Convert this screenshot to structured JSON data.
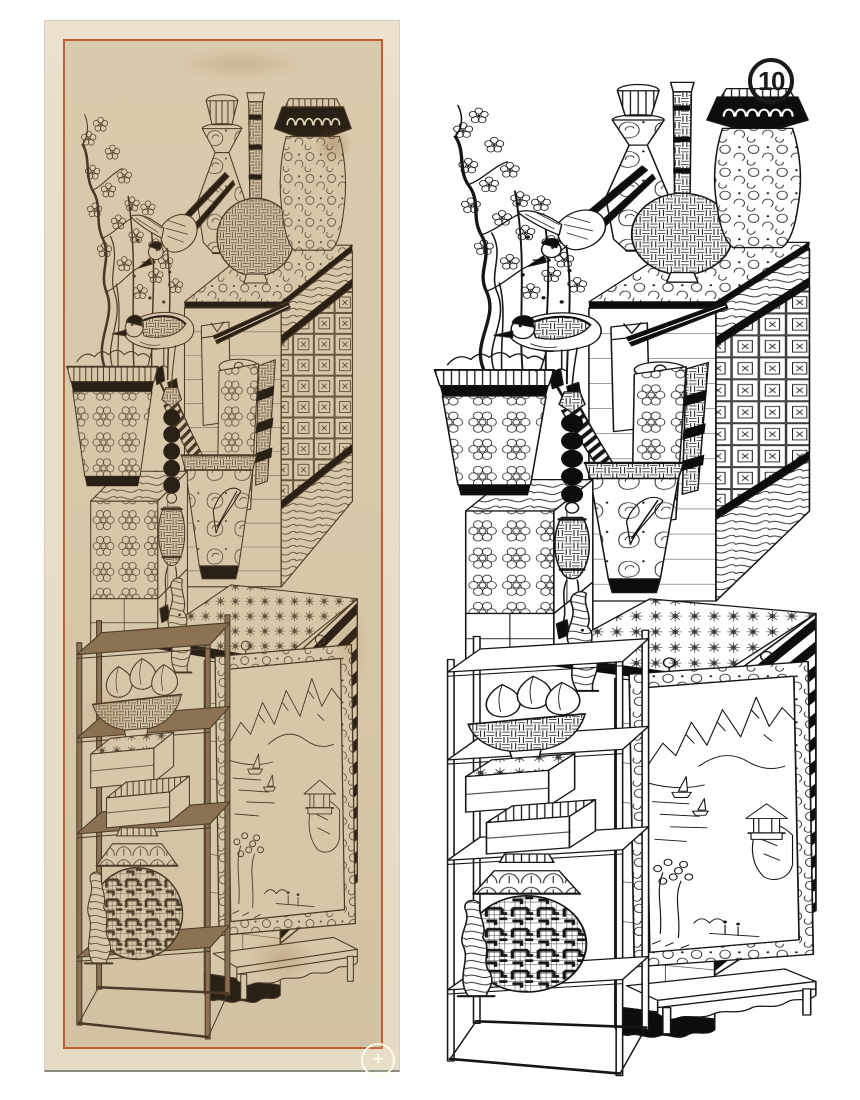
{
  "page": {
    "background_color": "#ffffff"
  },
  "figure_badge": {
    "number": "10",
    "color": "#1a1a1a"
  },
  "left_panel": {
    "label": "painting-photograph",
    "mat_color": "#e9dec8",
    "paper_color": "#d7c7a9",
    "border_color": "#c05f33",
    "ink_color": "#4a3a27",
    "accent_dark": "#2a2116",
    "wood_color": "#8a7253",
    "highlight_color": "#e0d2b6",
    "zoom_button_label": "+"
  },
  "right_panel": {
    "label": "line-drawing",
    "background_color": "#ffffff",
    "ink_color": "#161616",
    "accent_dark": "#0d0d0d"
  },
  "artwork": {
    "type": "chaekgeori-still-life-panel",
    "depicted_elements": [
      "plum-blossom-branch",
      "diving-bird",
      "perched-bird",
      "flowerpot-planter",
      "faceted-bottle-vase",
      "long-necked-vase",
      "lidded-floral-jar",
      "patterned-books-chest",
      "scroll-and-brush-pot",
      "bead-tassel",
      "wood-grain-box",
      "display-stand",
      "bowl-of-peaches",
      "stacked-boxes",
      "round-fret-patterned-box",
      "scholar-rocks",
      "framed-landscape-painting",
      "low-table"
    ]
  }
}
